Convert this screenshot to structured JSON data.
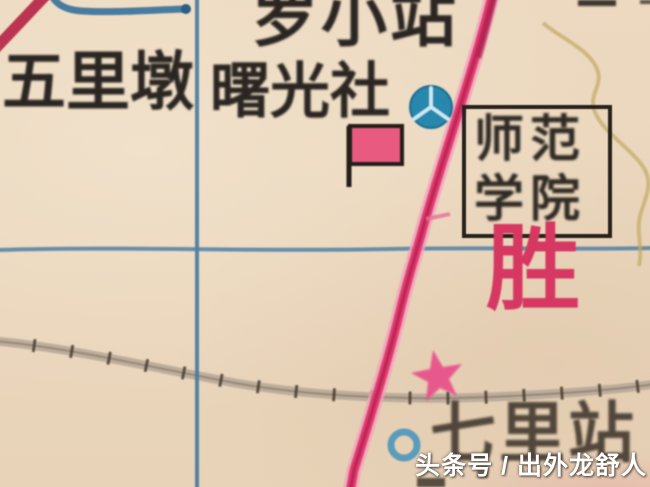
{
  "map": {
    "labels": {
      "wulidun": "五里墩",
      "top_station": "罗小站",
      "shuguang_commune": "曙光社",
      "college_line1": "师范",
      "college_line2": "学院",
      "sheng": "胜",
      "qili_station": "七里站"
    },
    "watermark": "头条号 / 出外龙舒人",
    "symbols": {
      "blue_three_spoke_circle": "factory-circle-icon",
      "pink_flag": "flag-icon",
      "pink_star": "star-icon",
      "blue_ring": "ring-icon",
      "railway": "railway-line",
      "road": "main-road",
      "grid_lines": "blue-grid-lines",
      "stream": "yellow-stream"
    },
    "colors": {
      "background": "#ead7be",
      "grid_blue": "#4779a0",
      "road_pink": "#e23c6f",
      "road_core": "#9e1544",
      "road_halo": "#f0a3bd",
      "red_line": "#bb3450",
      "stream_yellow": "#c3aa66",
      "rail_band": "#b1a294",
      "rail_tie": "#44382c",
      "ink_black": "#2b2622",
      "label_pink": "#d63862",
      "circle_blue": "#2787ad",
      "ring_blue": "#5b9cbb",
      "flag_pink": "#e85a80",
      "star_pink": "#e8538a",
      "watermark_white": "#ffffff"
    }
  }
}
